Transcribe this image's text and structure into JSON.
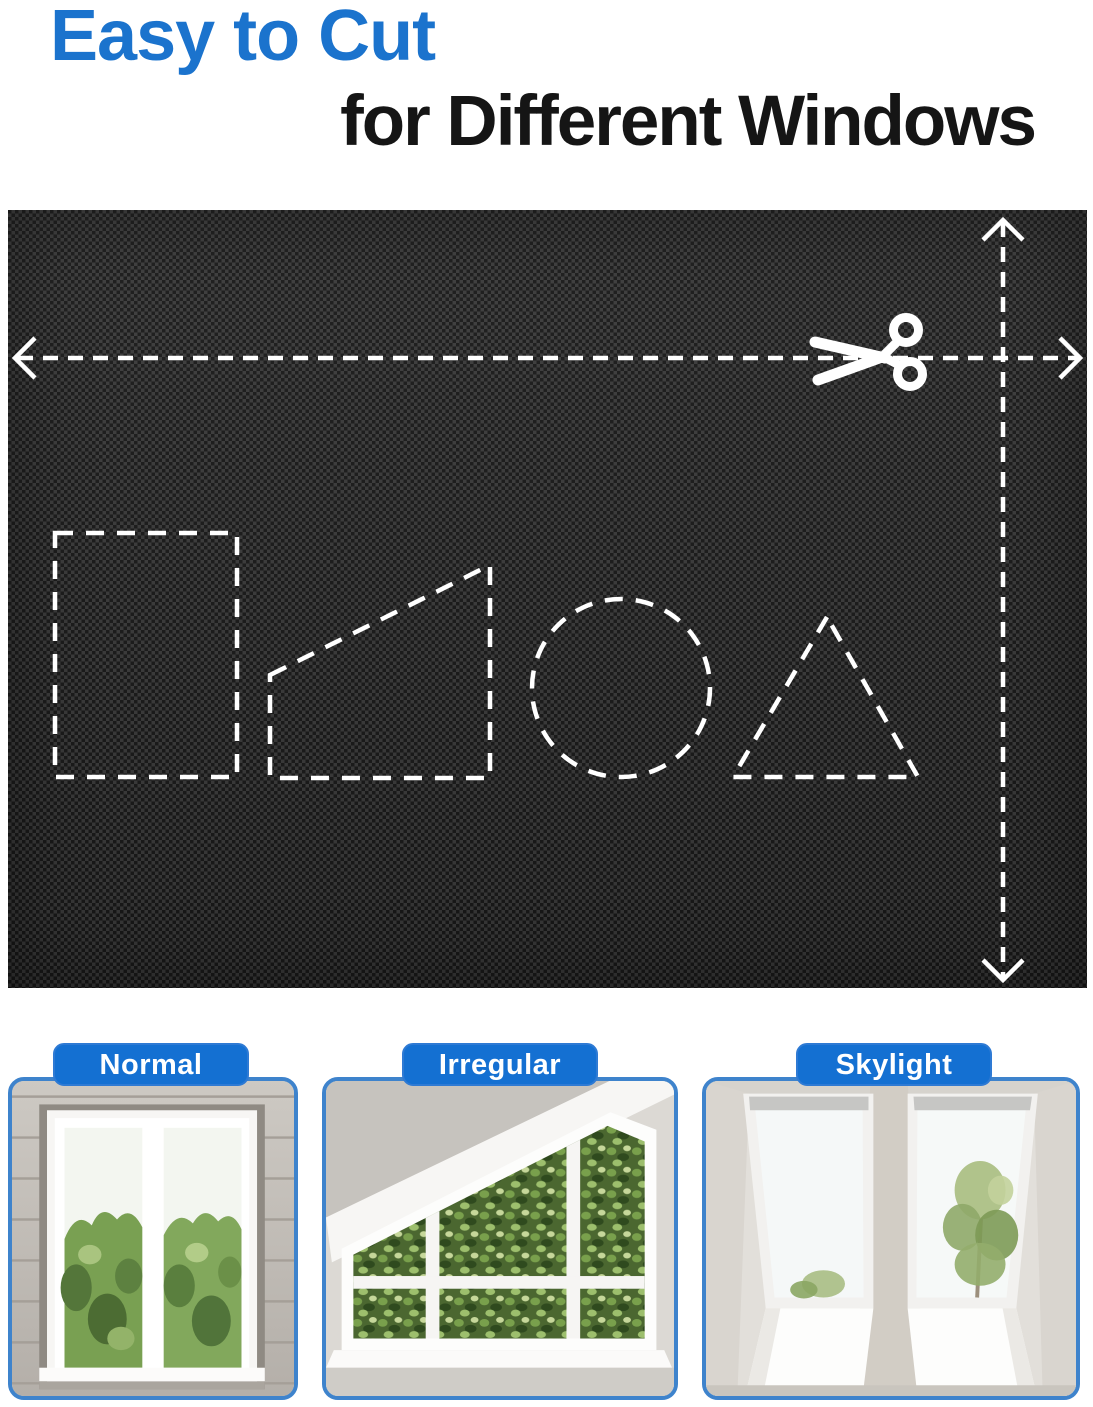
{
  "header": {
    "title": "Easy to Cut",
    "subtitle": "for Different Windows"
  },
  "colors": {
    "title_blue": "#1b73cd",
    "label_blue": "#1470d2",
    "card_border_blue": "#3e83cc",
    "panel_black": "#262626",
    "dash_white": "#ffffff"
  },
  "panel": {
    "icons": [
      "scissors-icon",
      "arrow-left-icon",
      "arrow-right-icon",
      "arrow-up-icon",
      "arrow-down-icon"
    ],
    "cut_shapes": [
      "rectangle",
      "right-trapezoid",
      "circle",
      "triangle"
    ]
  },
  "cards": [
    {
      "label": "Normal"
    },
    {
      "label": "Irregular"
    },
    {
      "label": "Skylight"
    }
  ]
}
